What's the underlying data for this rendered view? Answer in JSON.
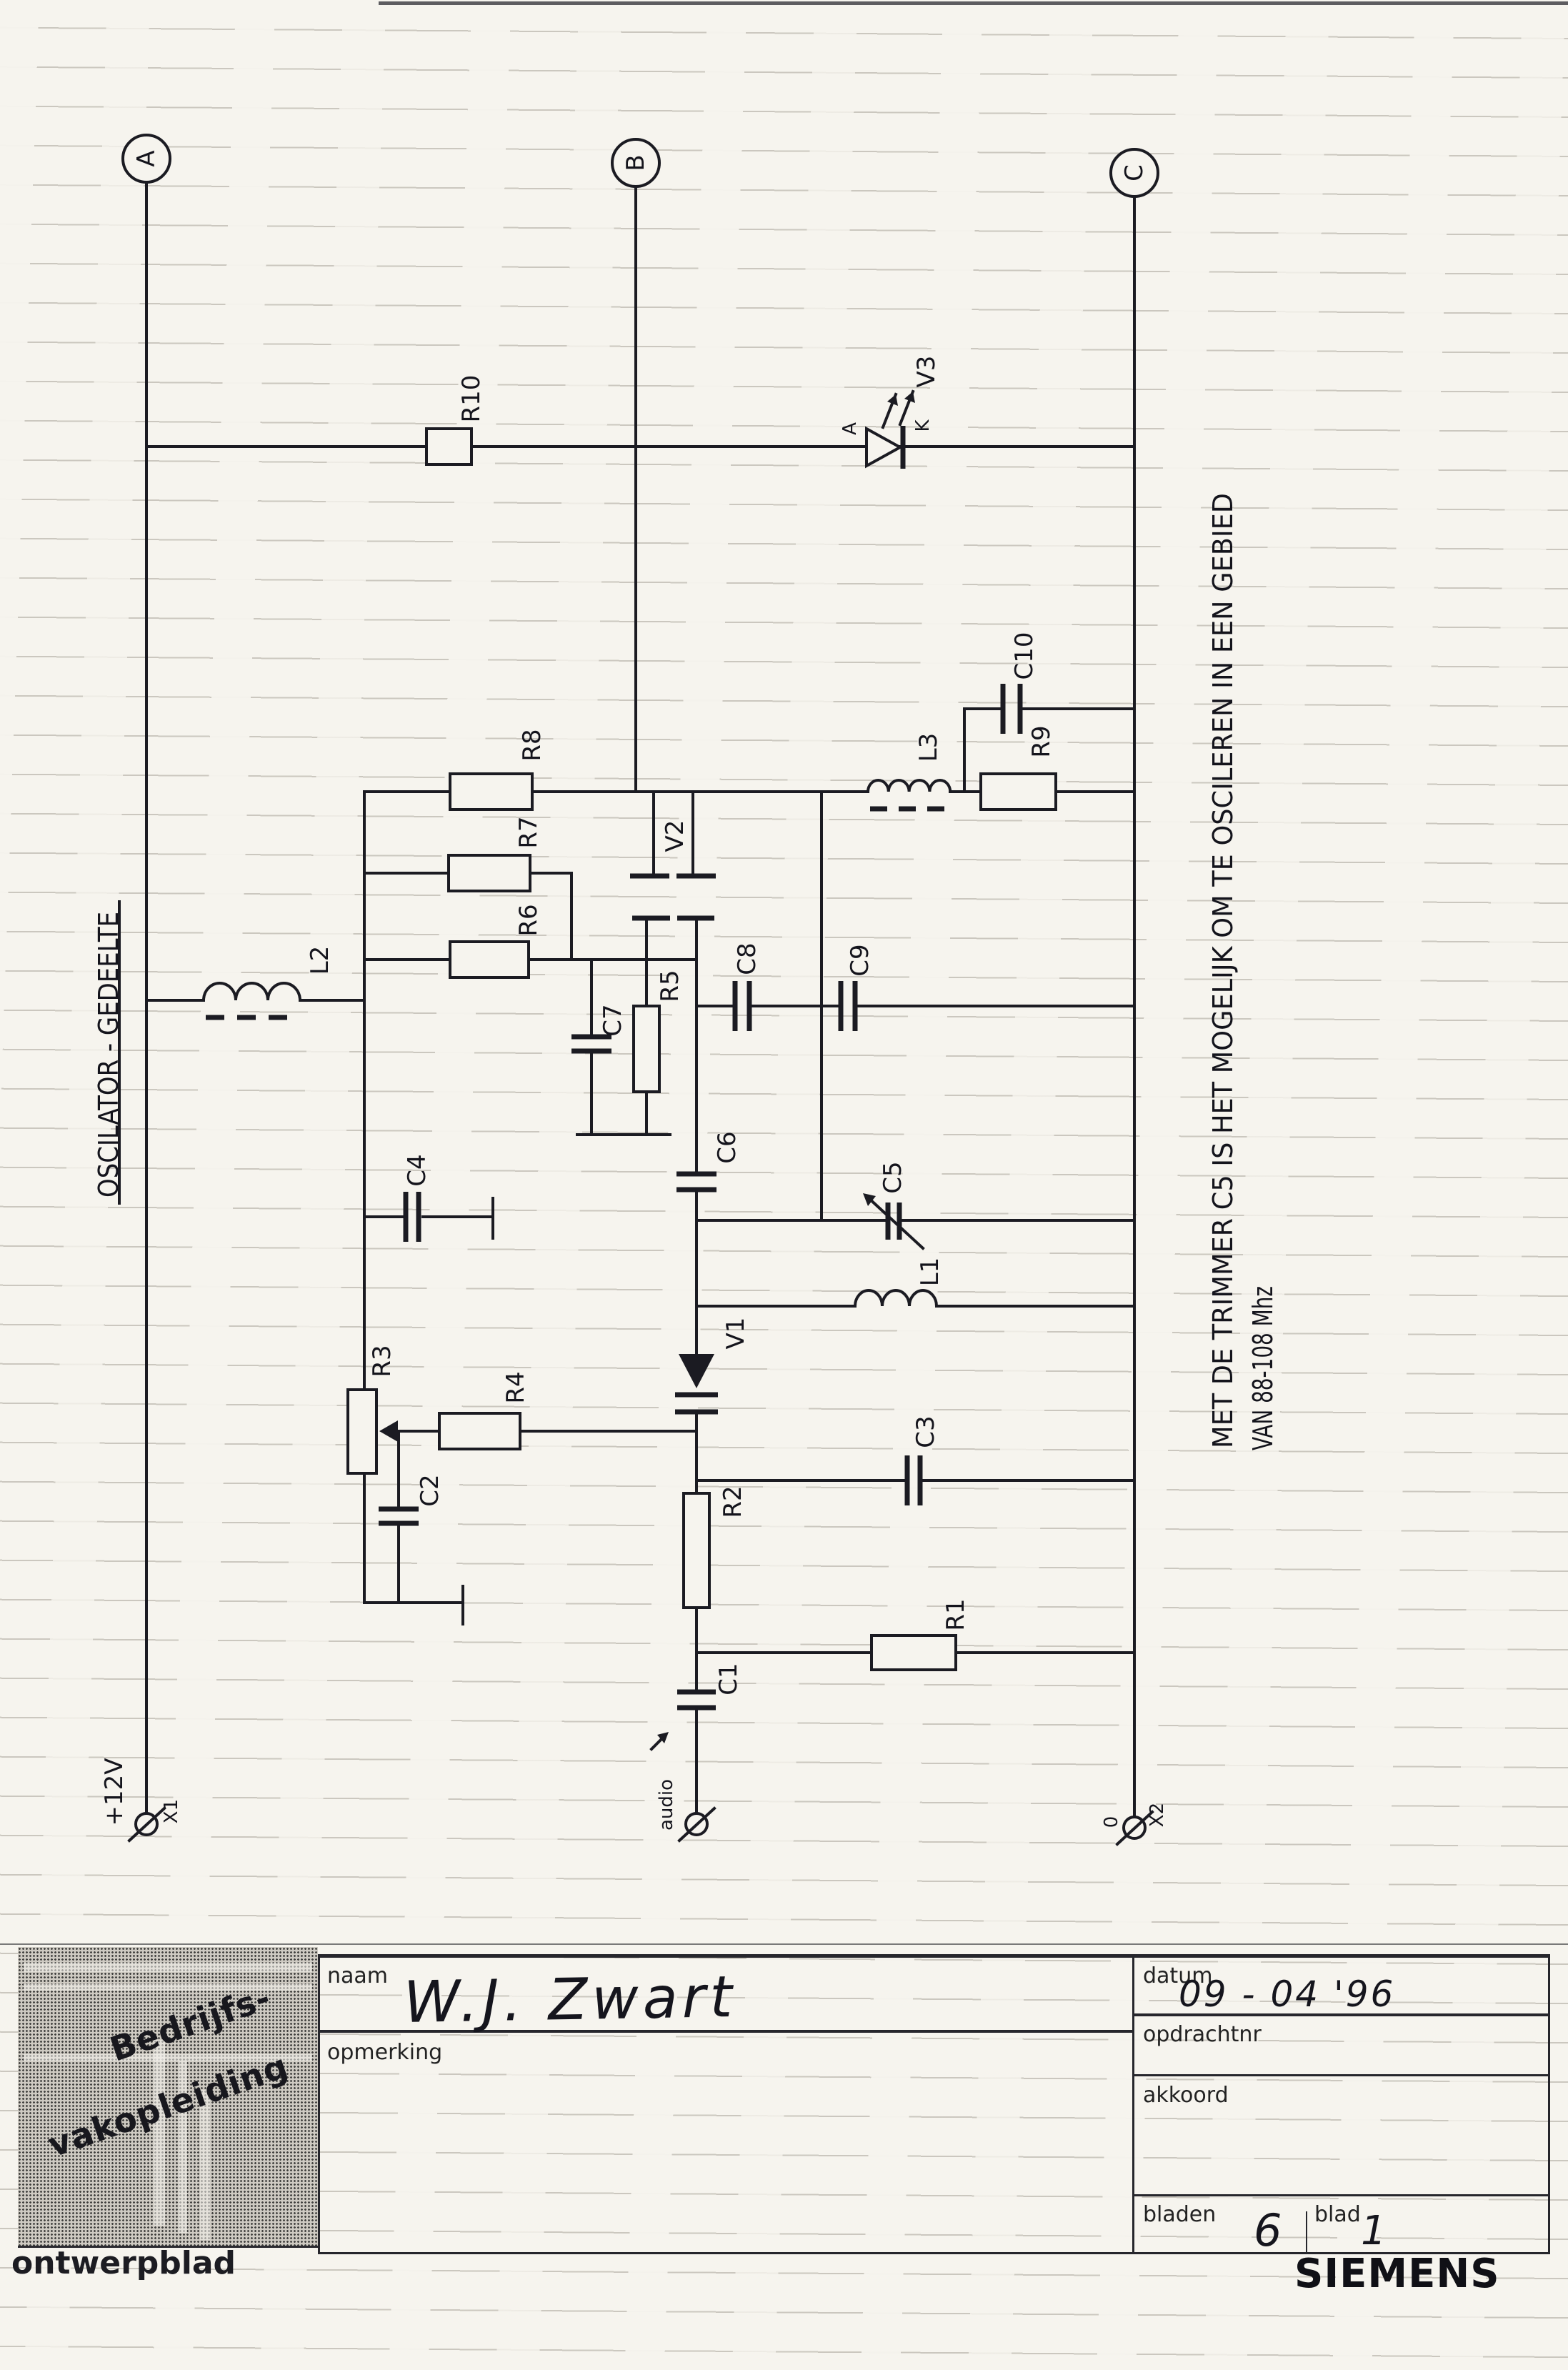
{
  "title": "OSCILATOR - GEDEELTE",
  "terminals": {
    "a": "A",
    "b": "B",
    "c": "C",
    "x1": "X1",
    "x2": "X2",
    "plus12v": "+12V",
    "zero": "0",
    "audio": "audio"
  },
  "components": {
    "r1": "R1",
    "r2": "R2",
    "r3": "R3",
    "r4": "R4",
    "r5": "R5",
    "r6": "R6",
    "r7": "R7",
    "r8": "R8",
    "r9": "R9",
    "r10": "R10",
    "c1": "C1",
    "c2": "C2",
    "c3": "C3",
    "c4": "C4",
    "c5": "C5",
    "c6": "C6",
    "c7": "C7",
    "c8": "C8",
    "c9": "C9",
    "c10": "C10",
    "l1": "L1",
    "l2": "L2",
    "l3": "L3",
    "v1": "V1",
    "v2": "V2",
    "v3": "V3",
    "v3_anode": "A",
    "v3_cathode": "K"
  },
  "note": {
    "line1": "MET DE TRIMMER C5 IS HET MOGELIJK OM TE OSCILEREN IN EEN GEBIED",
    "line2": "VAN 88-108 Mhz"
  },
  "title_block": {
    "naam_label": "naam",
    "naam_value": "W.J. Zwart",
    "opmerking_label": "opmerking",
    "datum_label": "datum",
    "datum_value": "09 - 04 '96",
    "opdrachtnr_label": "opdrachtnr",
    "akkoord_label": "akkoord",
    "bladen_label": "bladen",
    "bladen_value": "6",
    "blad_label": "blad",
    "blad_value": "1",
    "sheet_type": "ontwerpblad",
    "brand": "SIEMENS",
    "logo_line1": "Bedrijfs-",
    "logo_line2": "vakopleiding"
  }
}
